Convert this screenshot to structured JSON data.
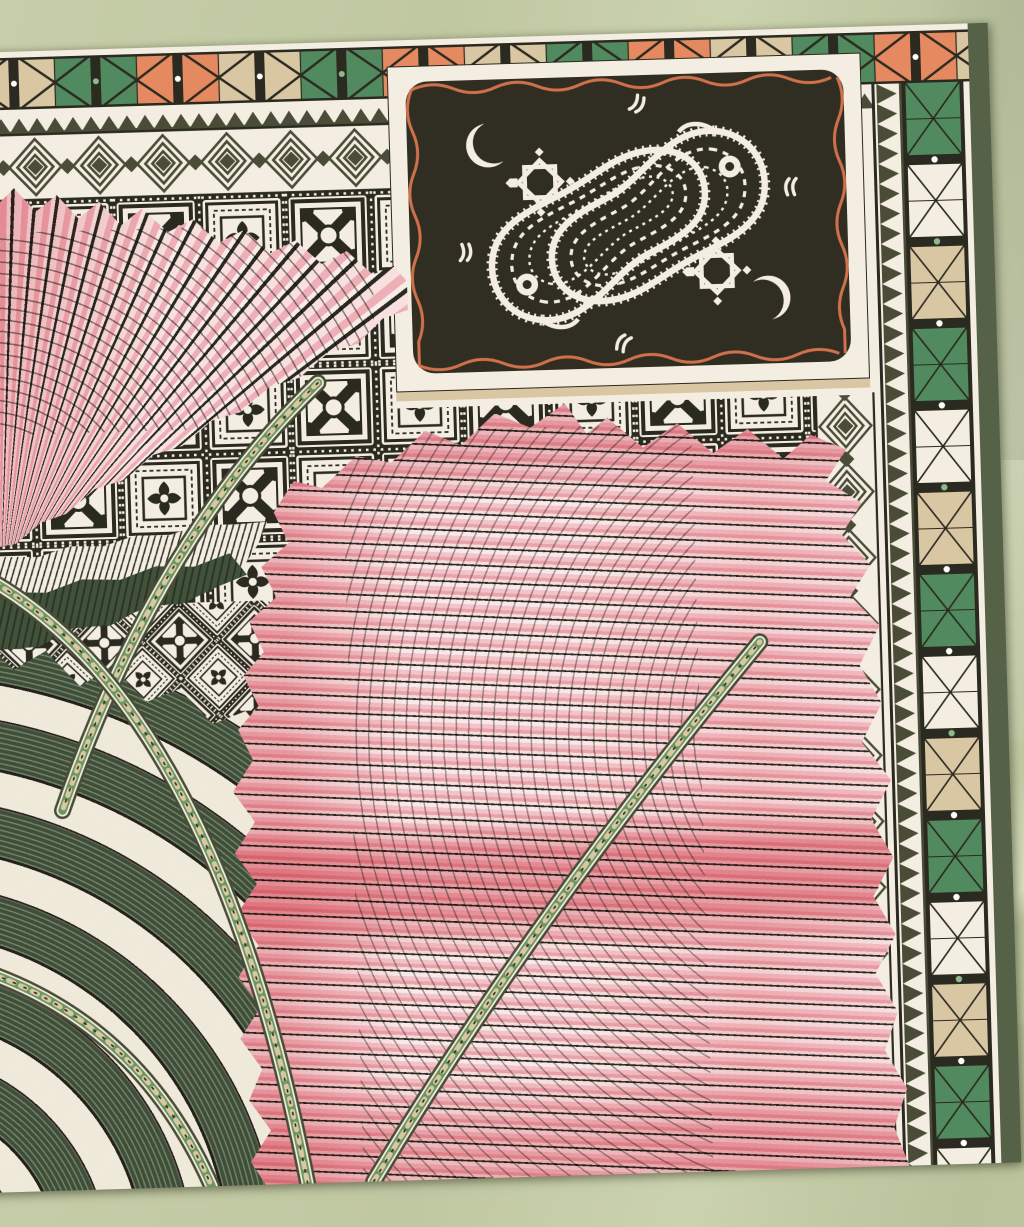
{
  "meta": {
    "type": "photograph",
    "subject": "Corner of a printed silk scarf laid on sage-green satin fabric",
    "style": "geometric ethnic print with pleated fan motifs",
    "view": "top-down close-up, scarf slightly rotated",
    "scarf_rotation_deg": -1.7
  },
  "colors": {
    "fabric": "#c1c9a3",
    "fabric_hi": "#d3d9b8",
    "cream": "#f3eee1",
    "ink": "#2b2a20",
    "panel": "#302e23",
    "olive": "#4a4c37",
    "olive_edge": "#556247",
    "orange": "#e58a60",
    "tan": "#d9c6a3",
    "green": "#518a5e",
    "green_dot": "#8fb98a",
    "green_dark": "#41513a",
    "green_deep": "#283223",
    "pink_pale": "#f8e7e6",
    "pink_light": "#f1c3c8",
    "pink_mid": "#e9a3ac",
    "pink_deep": "#e2838f",
    "coral": "#e06d79",
    "rust": "#d0714b"
  },
  "scarf": {
    "hem": "cream rolled hem",
    "top_border": {
      "name": "triangle-square strip",
      "square_sequence": [
        "orange",
        "tan",
        "tan",
        "green",
        "green",
        "orange"
      ],
      "separator": "black bar with small center dot",
      "dot_colors": [
        "white",
        "green"
      ]
    },
    "sawtooth_border": {
      "name": "sawtooth band",
      "tooth_color": "dark olive on cream"
    },
    "diamond_border": {
      "name": "nested concentric diamonds with solid olive centers"
    },
    "tile_field": {
      "name": "checkerboard of carved tiles",
      "motifs": [
        "X-cross tile with corner fans and ring center",
        "rosette tile in nested frames"
      ],
      "grout": "black with white dotted lines",
      "variants": [
        "upright grid (upper area)",
        "45-degree diagonal grid (lower left)"
      ]
    },
    "right_column": {
      "name": "tile border column",
      "square_sequence": [
        "green",
        "green",
        "white",
        "white",
        "tan",
        "tan"
      ],
      "separator": "black bar with white or green dot"
    },
    "edge_stripe": "olive green outer stripe",
    "panel": {
      "name": "paisley cartouche",
      "background": "black-olive",
      "frame": "cream with wavy rust line",
      "motifs": [
        "two interlocked white paisleys with ladder and fringe hatching",
        "sunburst rosettes",
        "crescents",
        "chevron tick marks"
      ]
    },
    "fans": [
      {
        "position": "upper left",
        "style": "pleated fan, pink gradient with dark ribs and net shading"
      },
      {
        "position": "center bottom",
        "style": "large pleated fan, pink with coral bands, dotted ribs and net shading"
      }
    ],
    "arcs": {
      "name": "concentric pleated arcs",
      "colors": [
        "dark green pleats",
        "cream patterned bands"
      ]
    },
    "ribbons": {
      "name": "beaded ribbon bands",
      "count": 4,
      "colors": [
        "green",
        "cream",
        "beige diamonds"
      ]
    },
    "under_fan_bands": [
      "white fine-pleat band",
      "dark green fine-pleat band"
    ]
  }
}
